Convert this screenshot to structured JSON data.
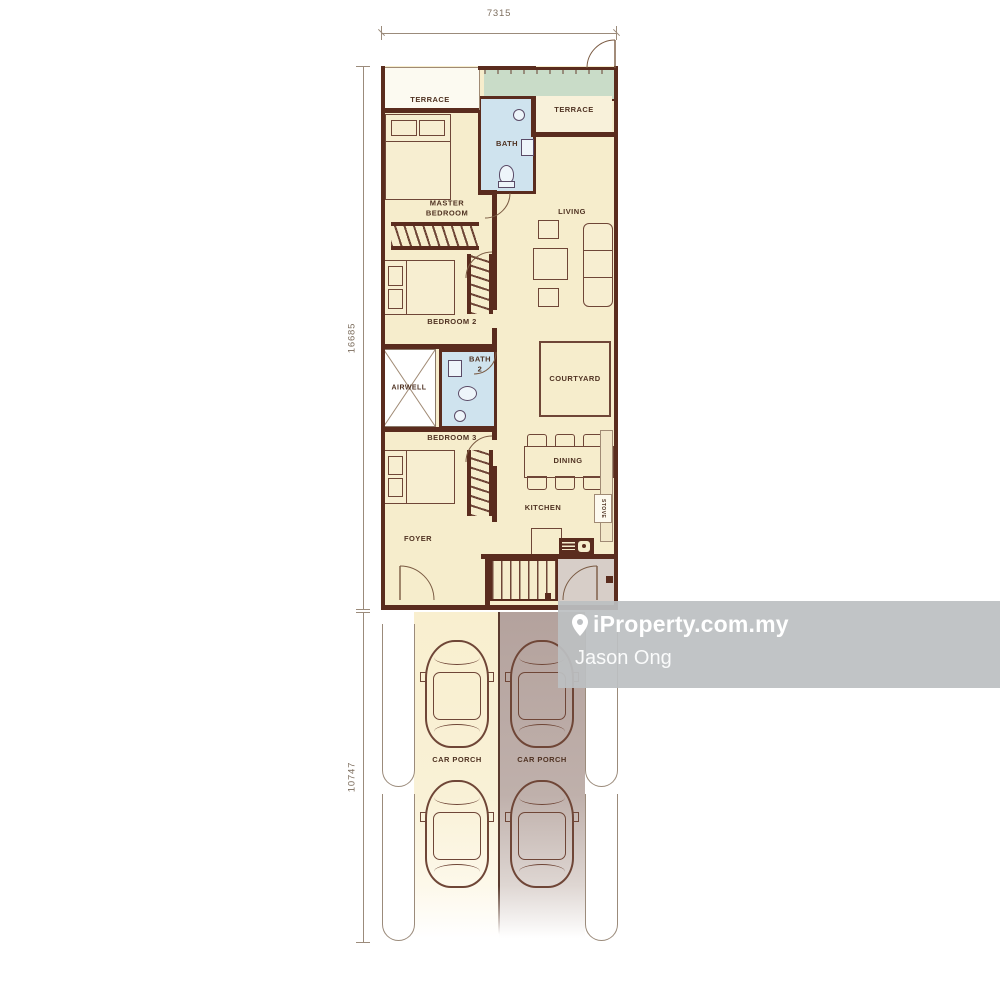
{
  "dims": {
    "top": "7315",
    "upper": "16685",
    "lower": "10747"
  },
  "rooms": {
    "terrace_left": "TERRACE",
    "terrace_right": "TERRACE",
    "bath1": "BATH",
    "master_bedroom": "MASTER\nBEDROOM",
    "living": "LIVING",
    "bedroom2": "BEDROOM 2",
    "airwell": "AIRWELL",
    "bath2": "BATH\n2",
    "courtyard": "COURTYARD",
    "bedroom3": "BEDROOM 3",
    "dining": "DINING",
    "kitchen": "KITCHEN",
    "stove": "STOVE",
    "foyer": "FOYER",
    "car_porch_left": "CAR PORCH",
    "car_porch_right": "CAR PORCH"
  },
  "watermark": {
    "brand": "iProperty.com.my",
    "agent": "Jason Ong",
    "icon": "location-pin-icon"
  },
  "colors": {
    "wall": "#5a2c1e",
    "floor_cream": "#f6edcc",
    "bath_blue": "#cfe3ee",
    "terrace_green": "#c9dcc8",
    "porch_left": "#f9efcf",
    "porch_right": "#b4a29d",
    "entry_gray": "#d7cec8",
    "watermark_bg": "#bcbfc2",
    "label_text": "#4f3222",
    "dim_text": "#7d6e5e"
  }
}
